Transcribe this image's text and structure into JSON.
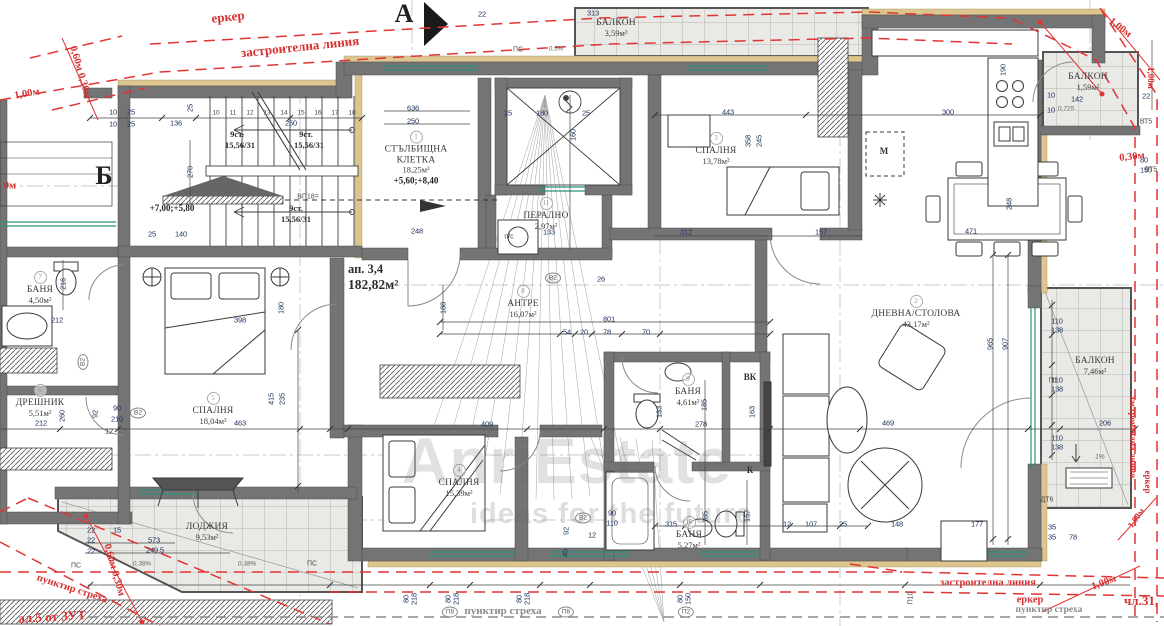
{
  "watermark": {
    "brand": "AnriEstate",
    "tagline": "ideas for the future"
  },
  "markers": {
    "a": "А",
    "b": "Б"
  },
  "apartment": {
    "label": "ап. 3,4",
    "area": "182,82м²"
  },
  "stairs": {
    "treads": [
      "10",
      "11",
      "12",
      "13",
      "14",
      "15",
      "16",
      "17",
      "18"
    ],
    "flight_label": "9ст.",
    "flight_ratio": "15,56/31",
    "stair_levels": "+7,00;+5,80",
    "core_levels": "+5,60;+8,40"
  },
  "rooms": [
    {
      "num": "1",
      "name": "СТЪЛБИЩНА КЛЕТКА",
      "area": "18,25м²",
      "extra": "+5,60;+8,40",
      "x": 416,
      "y": 158,
      "w": 88
    },
    {
      "num": "2",
      "name": "ДНЕВНА/СТОЛОВА",
      "area": "43,17м²",
      "x": 916,
      "y": 312,
      "w": 130
    },
    {
      "num": "3",
      "name": "СПАЛНЯ",
      "area": "13,78м²",
      "x": 716,
      "y": 149,
      "w": 70
    },
    {
      "num": "4",
      "name": "СПАЛНЯ",
      "area": "15,39м²",
      "x": 459,
      "y": 481,
      "w": 70
    },
    {
      "num": "5",
      "name": "СПАЛНЯ",
      "area": "18,04м²",
      "x": 213,
      "y": 409,
      "w": 70
    },
    {
      "num": "6",
      "name": "ДРЕШНИК",
      "area": "5,51м²",
      "x": 40,
      "y": 401,
      "w": 70
    },
    {
      "num": "7",
      "name": "БАНЯ",
      "area": "4,50м²",
      "x": 40,
      "y": 288,
      "w": 60
    },
    {
      "num": "8",
      "name": "АНТРЕ",
      "area": "16,07м²",
      "x": 523,
      "y": 302,
      "w": 60
    },
    {
      "num": "9",
      "name": "БАНЯ",
      "area": "4,61м²",
      "x": 688,
      "y": 390,
      "w": 60
    },
    {
      "num": "10",
      "name": "БАНЯ",
      "area": "5,27м²",
      "x": 689,
      "y": 533,
      "w": 60
    },
    {
      "num": "11",
      "name": "ПЕРАЛНО",
      "area": "2,97м²",
      "x": 546,
      "y": 214,
      "w": 70
    },
    {
      "name": "ЛОДЖИЯ",
      "area": "9,53м²",
      "x": 207,
      "y": 532,
      "w": 70
    },
    {
      "name": "БАЛКОН",
      "area": "3,59м²",
      "x": 616,
      "y": 28,
      "w": 70
    },
    {
      "name": "БАЛКОН",
      "area": "1,59м²",
      "x": 1088,
      "y": 82,
      "w": 70
    },
    {
      "name": "БАЛКОН",
      "area": "7,46м²",
      "x": 1095,
      "y": 366,
      "w": 70
    }
  ],
  "annotations": [
    {
      "t": "еркер",
      "x": 228,
      "y": 17,
      "r": -6,
      "cls": "red-lg"
    },
    {
      "t": "застроителна линия",
      "x": 300,
      "y": 47,
      "r": -6,
      "cls": "red-lg"
    },
    {
      "t": "1,00м",
      "x": 27,
      "y": 94,
      "r": -10,
      "cls": "red-md"
    },
    {
      "t": "0,60м 0,30м",
      "x": 80,
      "y": 72,
      "r": 74,
      "cls": "red-md"
    },
    {
      "t": "0м",
      "x": 10,
      "y": 186,
      "cls": "red-md"
    },
    {
      "t": "1,00м",
      "x": 1120,
      "y": 28,
      "r": 38,
      "cls": "red-md"
    },
    {
      "t": "1,00м",
      "x": 1151,
      "y": 78,
      "r": 90,
      "cls": "red-sm"
    },
    {
      "t": "0,30м",
      "x": 1132,
      "y": 157,
      "r": -6,
      "cls": "red-md"
    },
    {
      "t": "застроителна линия",
      "x": 1133,
      "y": 437,
      "r": 90,
      "cls": "red-sm"
    },
    {
      "t": "еркер",
      "x": 1148,
      "y": 482,
      "r": 90,
      "cls": "red-sm"
    },
    {
      "t": "пунктир стреха",
      "x": 72,
      "y": 589,
      "r": 18,
      "cls": "red-md"
    },
    {
      "t": "ал.5 от ЗУТ",
      "x": 52,
      "y": 617,
      "r": -3,
      "cls": "red-lg"
    },
    {
      "t": "0,60м 0,30м",
      "x": 114,
      "y": 570,
      "r": 74,
      "cls": "red-md"
    },
    {
      "t": "застроителна линия",
      "x": 988,
      "y": 583,
      "cls": "red-md"
    },
    {
      "t": "еркер",
      "x": 1030,
      "y": 600,
      "cls": "red-md"
    },
    {
      "t": "1,00м",
      "x": 1104,
      "y": 583,
      "r": -20,
      "cls": "red-md"
    },
    {
      "t": "чл.31,",
      "x": 1141,
      "y": 601,
      "cls": "red-lg"
    },
    {
      "t": "1,00м",
      "x": 1136,
      "y": 518,
      "r": -55,
      "cls": "red-sm"
    },
    {
      "t": "пунктир стреха",
      "x": 503,
      "y": 611,
      "cls": "gray-md"
    },
    {
      "t": "пунктир стреха",
      "x": 1049,
      "y": 610,
      "cls": "gray-sm"
    },
    {
      "t": "9ст.",
      "x": 237,
      "y": 134,
      "cls": "stair"
    },
    {
      "t": "15,56/31",
      "x": 240,
      "y": 145,
      "cls": "stair"
    },
    {
      "t": "9ст.",
      "x": 306,
      "y": 134,
      "cls": "stair"
    },
    {
      "t": "15,56/31",
      "x": 309,
      "y": 145,
      "cls": "stair"
    },
    {
      "t": "9ст.",
      "x": 296,
      "y": 208,
      "cls": "stair"
    },
    {
      "t": "15,56/31",
      "x": 296,
      "y": 219,
      "cls": "stair"
    },
    {
      "t": "+7,00;+5,80",
      "x": 172,
      "y": 208,
      "cls": "lvl"
    },
    {
      "t": "ВК",
      "x": 750,
      "y": 377,
      "cls": "codeb"
    },
    {
      "t": "К",
      "x": 750,
      "y": 470,
      "cls": "codeb"
    },
    {
      "t": "М",
      "x": 884,
      "y": 151,
      "cls": "codeb"
    },
    {
      "t": "п/с",
      "x": 509,
      "y": 237,
      "cls": "code"
    },
    {
      "t": "ПС",
      "x": 76,
      "y": 566,
      "cls": "code"
    },
    {
      "t": "ПС",
      "x": 312,
      "y": 564,
      "cls": "code"
    },
    {
      "t": "ПС",
      "x": 518,
      "y": 50,
      "cls": "code"
    },
    {
      "t": "П1",
      "x": 1053,
      "y": 381,
      "cls": "code"
    },
    {
      "t": "П8",
      "x": 450,
      "y": 612,
      "cls": "oval"
    },
    {
      "t": "П8",
      "x": 566,
      "y": 612,
      "cls": "oval"
    },
    {
      "t": "П2",
      "x": 686,
      "y": 612,
      "cls": "oval"
    },
    {
      "t": "П10",
      "x": 911,
      "y": 598,
      "r": -90,
      "cls": "code"
    },
    {
      "t": "ДТ6",
      "x": 1047,
      "y": 500,
      "cls": "code"
    },
    {
      "t": "ВТ5",
      "x": 1146,
      "y": 122,
      "cls": "code"
    },
    {
      "t": "ВТ5",
      "x": 1151,
      "y": 170,
      "cls": "code"
    },
    {
      "t": "ВП18=",
      "x": 308,
      "y": 197,
      "cls": "code"
    },
    {
      "t": "В2",
      "x": 83,
      "y": 362,
      "r": -90,
      "cls": "oval"
    },
    {
      "t": "В2",
      "x": 138,
      "y": 413,
      "cls": "oval"
    },
    {
      "t": "В2",
      "x": 553,
      "y": 278,
      "cls": "oval"
    },
    {
      "t": "В2",
      "x": 583,
      "y": 518,
      "cls": "oval"
    },
    {
      "t": "0,38%",
      "x": 142,
      "y": 564,
      "cls": "tiny2"
    },
    {
      "t": "0,38%",
      "x": 247,
      "y": 564,
      "cls": "tiny2"
    },
    {
      "t": "1%",
      "x": 1100,
      "y": 457,
      "cls": "tiny2"
    },
    {
      "t": "0,5%",
      "x": 556,
      "y": 49,
      "cls": "tiny2"
    },
    {
      "t": "0,725",
      "x": 1066,
      "y": 109,
      "cls": "tiny2"
    }
  ],
  "dimensions": [
    {
      "t": "136",
      "x": 176,
      "y": 123
    },
    {
      "t": "250",
      "x": 291,
      "y": 123
    },
    {
      "t": "10",
      "x": 113,
      "y": 112
    },
    {
      "t": "25",
      "x": 131,
      "y": 112
    },
    {
      "t": "10",
      "x": 113,
      "y": 124
    },
    {
      "t": "25",
      "x": 131,
      "y": 124
    },
    {
      "t": "25",
      "x": 190,
      "y": 108,
      "r": -90
    },
    {
      "t": "270",
      "x": 190,
      "y": 172,
      "r": -90
    },
    {
      "t": "25",
      "x": 152,
      "y": 234
    },
    {
      "t": "140",
      "x": 181,
      "y": 234
    },
    {
      "t": "248",
      "x": 417,
      "y": 231
    },
    {
      "t": "636",
      "x": 413,
      "y": 108
    },
    {
      "t": "250",
      "x": 413,
      "y": 121
    },
    {
      "t": "22",
      "x": 482,
      "y": 14
    },
    {
      "t": "313",
      "x": 593,
      "y": 13
    },
    {
      "t": "25",
      "x": 508,
      "y": 113
    },
    {
      "t": "180",
      "x": 542,
      "y": 113
    },
    {
      "t": "25",
      "x": 586,
      "y": 113
    },
    {
      "t": "160",
      "x": 573,
      "y": 135,
      "r": -90
    },
    {
      "t": "443",
      "x": 728,
      "y": 112
    },
    {
      "t": "300",
      "x": 948,
      "y": 112
    },
    {
      "t": "358",
      "x": 748,
      "y": 141,
      "r": -90
    },
    {
      "t": "245",
      "x": 759,
      "y": 141,
      "r": -90
    },
    {
      "t": "312",
      "x": 686,
      "y": 232
    },
    {
      "t": "157",
      "x": 821,
      "y": 232
    },
    {
      "t": "471",
      "x": 971,
      "y": 231
    },
    {
      "t": "248",
      "x": 1009,
      "y": 204,
      "r": -90
    },
    {
      "t": "190",
      "x": 1003,
      "y": 70,
      "r": -90
    },
    {
      "t": "142",
      "x": 1077,
      "y": 99
    },
    {
      "t": "10",
      "x": 1051,
      "y": 95
    },
    {
      "t": "10",
      "x": 1051,
      "y": 110
    },
    {
      "t": "22",
      "x": 1146,
      "y": 96
    },
    {
      "t": "80",
      "x": 1144,
      "y": 160
    },
    {
      "t": "150",
      "x": 1146,
      "y": 170
    },
    {
      "t": "216",
      "x": 63,
      "y": 284,
      "r": -90
    },
    {
      "t": "212",
      "x": 57,
      "y": 320
    },
    {
      "t": "398",
      "x": 240,
      "y": 320
    },
    {
      "t": "180",
      "x": 281,
      "y": 308,
      "r": -90
    },
    {
      "t": "92",
      "x": 95,
      "y": 414,
      "r": -90
    },
    {
      "t": "260",
      "x": 62,
      "y": 416,
      "r": -90
    },
    {
      "t": "212",
      "x": 41,
      "y": 423
    },
    {
      "t": "463",
      "x": 240,
      "y": 423
    },
    {
      "t": "415",
      "x": 271,
      "y": 399,
      "r": -90
    },
    {
      "t": "235",
      "x": 282,
      "y": 399,
      "r": -90
    },
    {
      "t": "90",
      "x": 117,
      "y": 408
    },
    {
      "t": "210",
      "x": 117,
      "y": 419
    },
    {
      "t": "12",
      "x": 109,
      "y": 431
    },
    {
      "t": "188",
      "x": 443,
      "y": 308,
      "r": -90
    },
    {
      "t": "82",
      "x": 551,
      "y": 279
    },
    {
      "t": "26",
      "x": 601,
      "y": 279
    },
    {
      "t": "133",
      "x": 549,
      "y": 232
    },
    {
      "t": "801",
      "x": 609,
      "y": 319
    },
    {
      "t": "54",
      "x": 567,
      "y": 332
    },
    {
      "t": "20",
      "x": 584,
      "y": 332
    },
    {
      "t": "78",
      "x": 607,
      "y": 332
    },
    {
      "t": "70",
      "x": 646,
      "y": 332
    },
    {
      "t": "409",
      "x": 487,
      "y": 424
    },
    {
      "t": "278",
      "x": 701,
      "y": 424
    },
    {
      "t": "469",
      "x": 888,
      "y": 423
    },
    {
      "t": "206",
      "x": 1105,
      "y": 423
    },
    {
      "t": "133",
      "x": 659,
      "y": 412,
      "r": -90
    },
    {
      "t": "163",
      "x": 752,
      "y": 412,
      "r": -90
    },
    {
      "t": "185",
      "x": 704,
      "y": 405,
      "r": -90
    },
    {
      "t": "185",
      "x": 705,
      "y": 517,
      "r": -90
    },
    {
      "t": "157",
      "x": 747,
      "y": 516,
      "r": -90
    },
    {
      "t": "315",
      "x": 671,
      "y": 524
    },
    {
      "t": "12",
      "x": 787,
      "y": 524
    },
    {
      "t": "107",
      "x": 811,
      "y": 524
    },
    {
      "t": "25",
      "x": 843,
      "y": 524
    },
    {
      "t": "965",
      "x": 990,
      "y": 344,
      "r": -90
    },
    {
      "t": "907",
      "x": 1005,
      "y": 344,
      "r": -90
    },
    {
      "t": "110",
      "x": 1057,
      "y": 321
    },
    {
      "t": "138",
      "x": 1057,
      "y": 330
    },
    {
      "t": "110",
      "x": 1057,
      "y": 380
    },
    {
      "t": "138",
      "x": 1057,
      "y": 389
    },
    {
      "t": "110",
      "x": 1057,
      "y": 438
    },
    {
      "t": "138",
      "x": 1057,
      "y": 447
    },
    {
      "t": "148",
      "x": 897,
      "y": 524
    },
    {
      "t": "177",
      "x": 977,
      "y": 524
    },
    {
      "t": "35",
      "x": 1052,
      "y": 527
    },
    {
      "t": "35",
      "x": 1052,
      "y": 537
    },
    {
      "t": "78",
      "x": 1073,
      "y": 537
    },
    {
      "t": "573",
      "x": 154,
      "y": 540
    },
    {
      "t": "249,5",
      "x": 155,
      "y": 550
    },
    {
      "t": "22",
      "x": 91,
      "y": 530
    },
    {
      "t": "22",
      "x": 91,
      "y": 540
    },
    {
      "t": "22",
      "x": 91,
      "y": 551
    },
    {
      "t": "15",
      "x": 117,
      "y": 530
    },
    {
      "t": "90",
      "x": 612,
      "y": 513
    },
    {
      "t": "110",
      "x": 612,
      "y": 523
    },
    {
      "t": "92",
      "x": 566,
      "y": 531,
      "r": -90
    },
    {
      "t": "12",
      "x": 592,
      "y": 535
    },
    {
      "t": "45",
      "x": 565,
      "y": 553,
      "r": -90
    },
    {
      "t": "80",
      "x": 406,
      "y": 599,
      "r": -90
    },
    {
      "t": "218",
      "x": 414,
      "y": 599,
      "r": -90
    },
    {
      "t": "80",
      "x": 448,
      "y": 599,
      "r": -90
    },
    {
      "t": "218",
      "x": 456,
      "y": 599,
      "r": -90
    },
    {
      "t": "80",
      "x": 519,
      "y": 599,
      "r": -90
    },
    {
      "t": "218",
      "x": 527,
      "y": 599,
      "r": -90
    },
    {
      "t": "80",
      "x": 680,
      "y": 599,
      "r": -90
    },
    {
      "t": "150",
      "x": 688,
      "y": 599,
      "r": -90
    }
  ]
}
